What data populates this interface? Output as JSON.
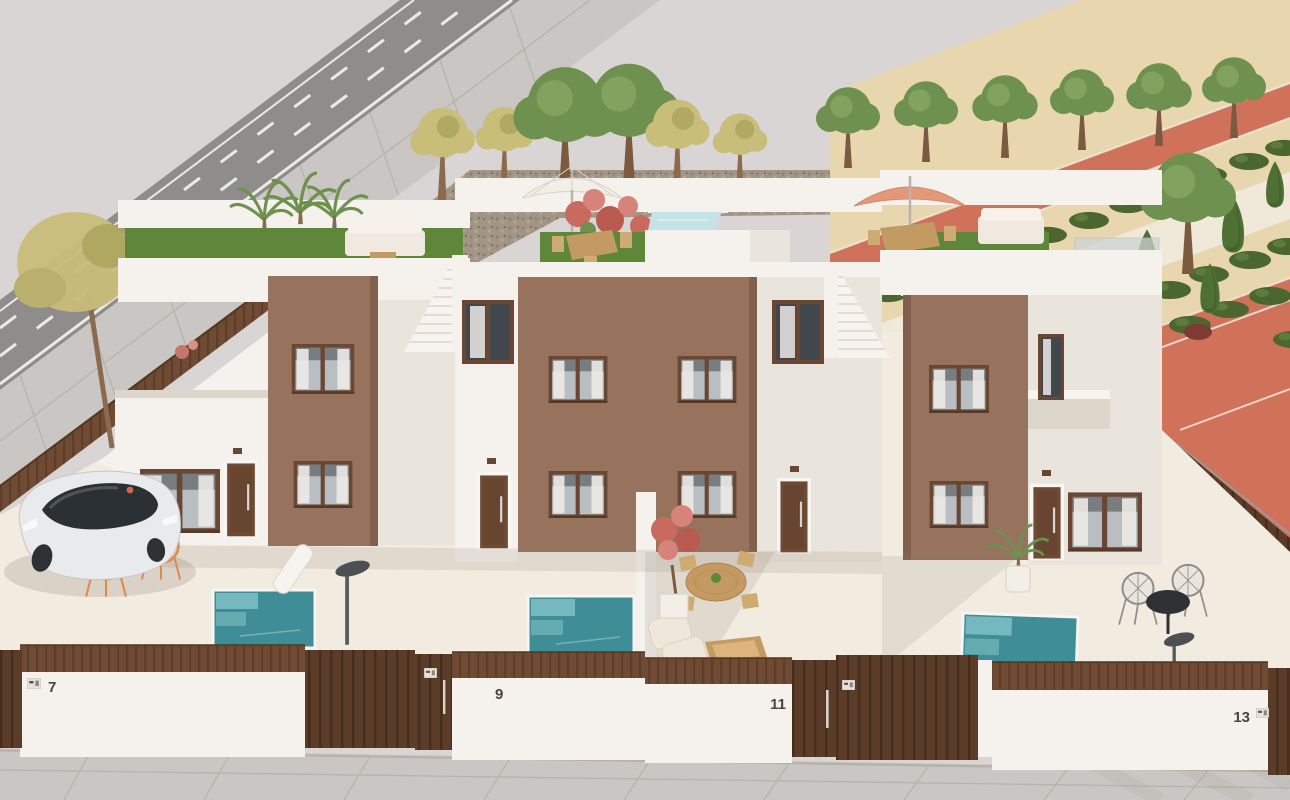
{
  "scene": {
    "description": "Aerial daytime 3D render of four modern two-storey white townhouses with brown brick accent facades. Each home has a walled front patio, three with small teal plunge pools, brown slatted fences and gates with house numbers. Rooftop terraces hold sofas, dining sets, parasols and a small roof pool. A road with a parked white car runs along the left; a landscaped park with terracotta paths, hedges and trees lies to the right.",
    "time_of_day": "day"
  },
  "houses": [
    {
      "number": "7"
    },
    {
      "number": "9"
    },
    {
      "number": "11"
    },
    {
      "number": "13"
    }
  ],
  "objects": {
    "left_street": [
      "asphalt road with white dashed lines",
      "tiled sidewalk",
      "brown slatted fence",
      "yellow-green tree"
    ],
    "vehicles": [
      "white hatchback car parked in driveway"
    ],
    "pools": [
      "plunge pool house 7",
      "plunge pool house 9",
      "plunge pool house 13",
      "rooftop pool centre block"
    ],
    "roof_terraces": [
      "lounge sofa on turf (left)",
      "white parasol with dining table (centre)",
      "salmon parasol with dining set and sofa (right)"
    ],
    "park": [
      "terracotta promenade bands",
      "sand strips with hedge rows",
      "cream walking path",
      "cypress and olive trees"
    ]
  },
  "palette": {
    "sky": "#d9d5d4",
    "asphalt": "#8f8d8c",
    "roadline": "#eceae7",
    "sidewalk": "#c9c6c3",
    "wall": "#f5f2ed",
    "wallShade": "#eae5dc",
    "wallDark": "#ddd6cb",
    "brick": "#97725d",
    "brickShade": "#82604e",
    "fence": "#6f4b34",
    "fenceDark": "#53361f",
    "gateDark": "#5a3c28",
    "frame": "#6a4733",
    "glass": "#b9bec2",
    "glassDark": "#41474c",
    "curtain": "#eceae6",
    "pool": "#3f8e97",
    "poolLight": "#7fc0c3",
    "roofPool": "#c3e3e6",
    "turf": "#5f8739",
    "gravel": "#a39585",
    "terracotta": "#d0715a",
    "sand": "#e8d7ae",
    "path": "#f0e9d9",
    "hedge": "#4b662f",
    "tree": "#6f9150",
    "treeYellow": "#c9bd7a",
    "cypress": "#4f7034",
    "patio": "#f1ebe0",
    "shadow": "#8a7d6b",
    "wood": "#c49a63",
    "cream": "#ece5d6",
    "metal": "#565a5e",
    "orange": "#e0894d",
    "parasol": "#f2eee8",
    "parasolSalmon": "#e59878",
    "carBody": "#e9eaec",
    "carGlass": "#2b3034",
    "number": "#4a443c"
  }
}
